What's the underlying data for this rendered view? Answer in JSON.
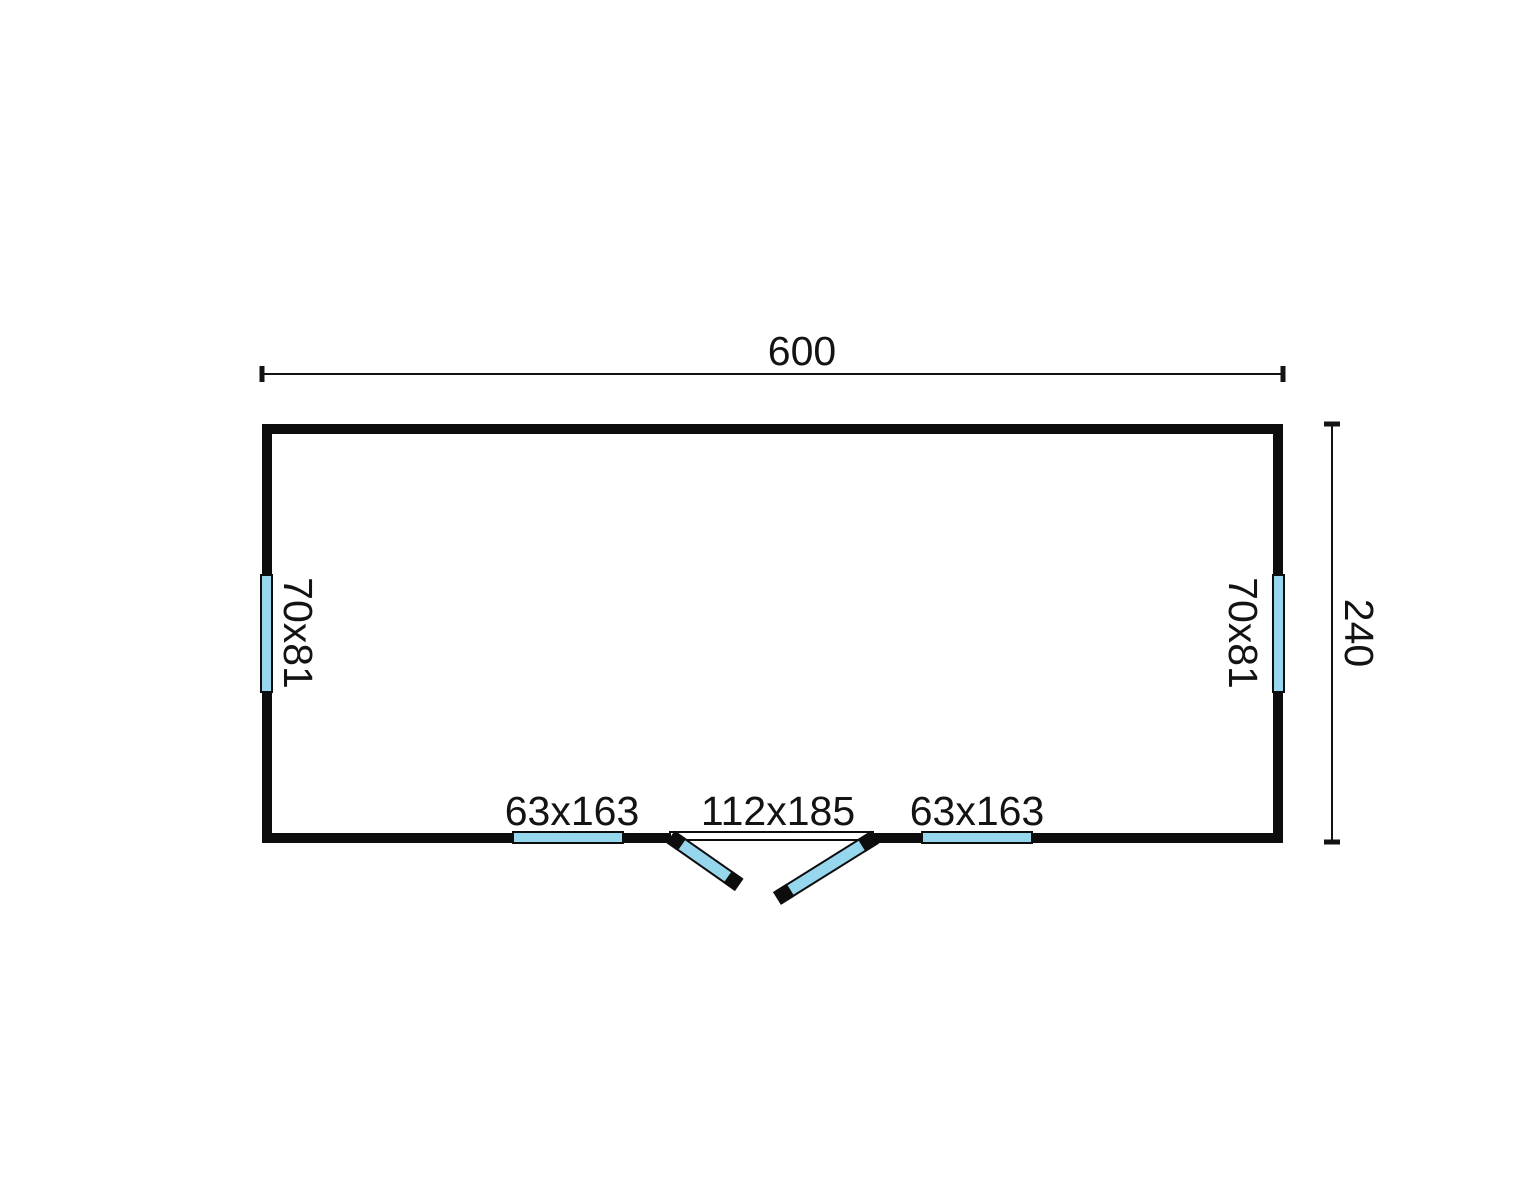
{
  "floorplan": {
    "dimensions": {
      "width_label": "600",
      "depth_label": "240"
    },
    "openings": {
      "window_left": "70x81",
      "window_right": "70x81",
      "window_bottom_left": "63x163",
      "window_bottom_right": "63x163",
      "double_door": "112x185"
    },
    "colors": {
      "glazing": "#96d7ee",
      "wall": "#0d0d0d",
      "line": "#131313",
      "background": "#ffffff"
    }
  }
}
